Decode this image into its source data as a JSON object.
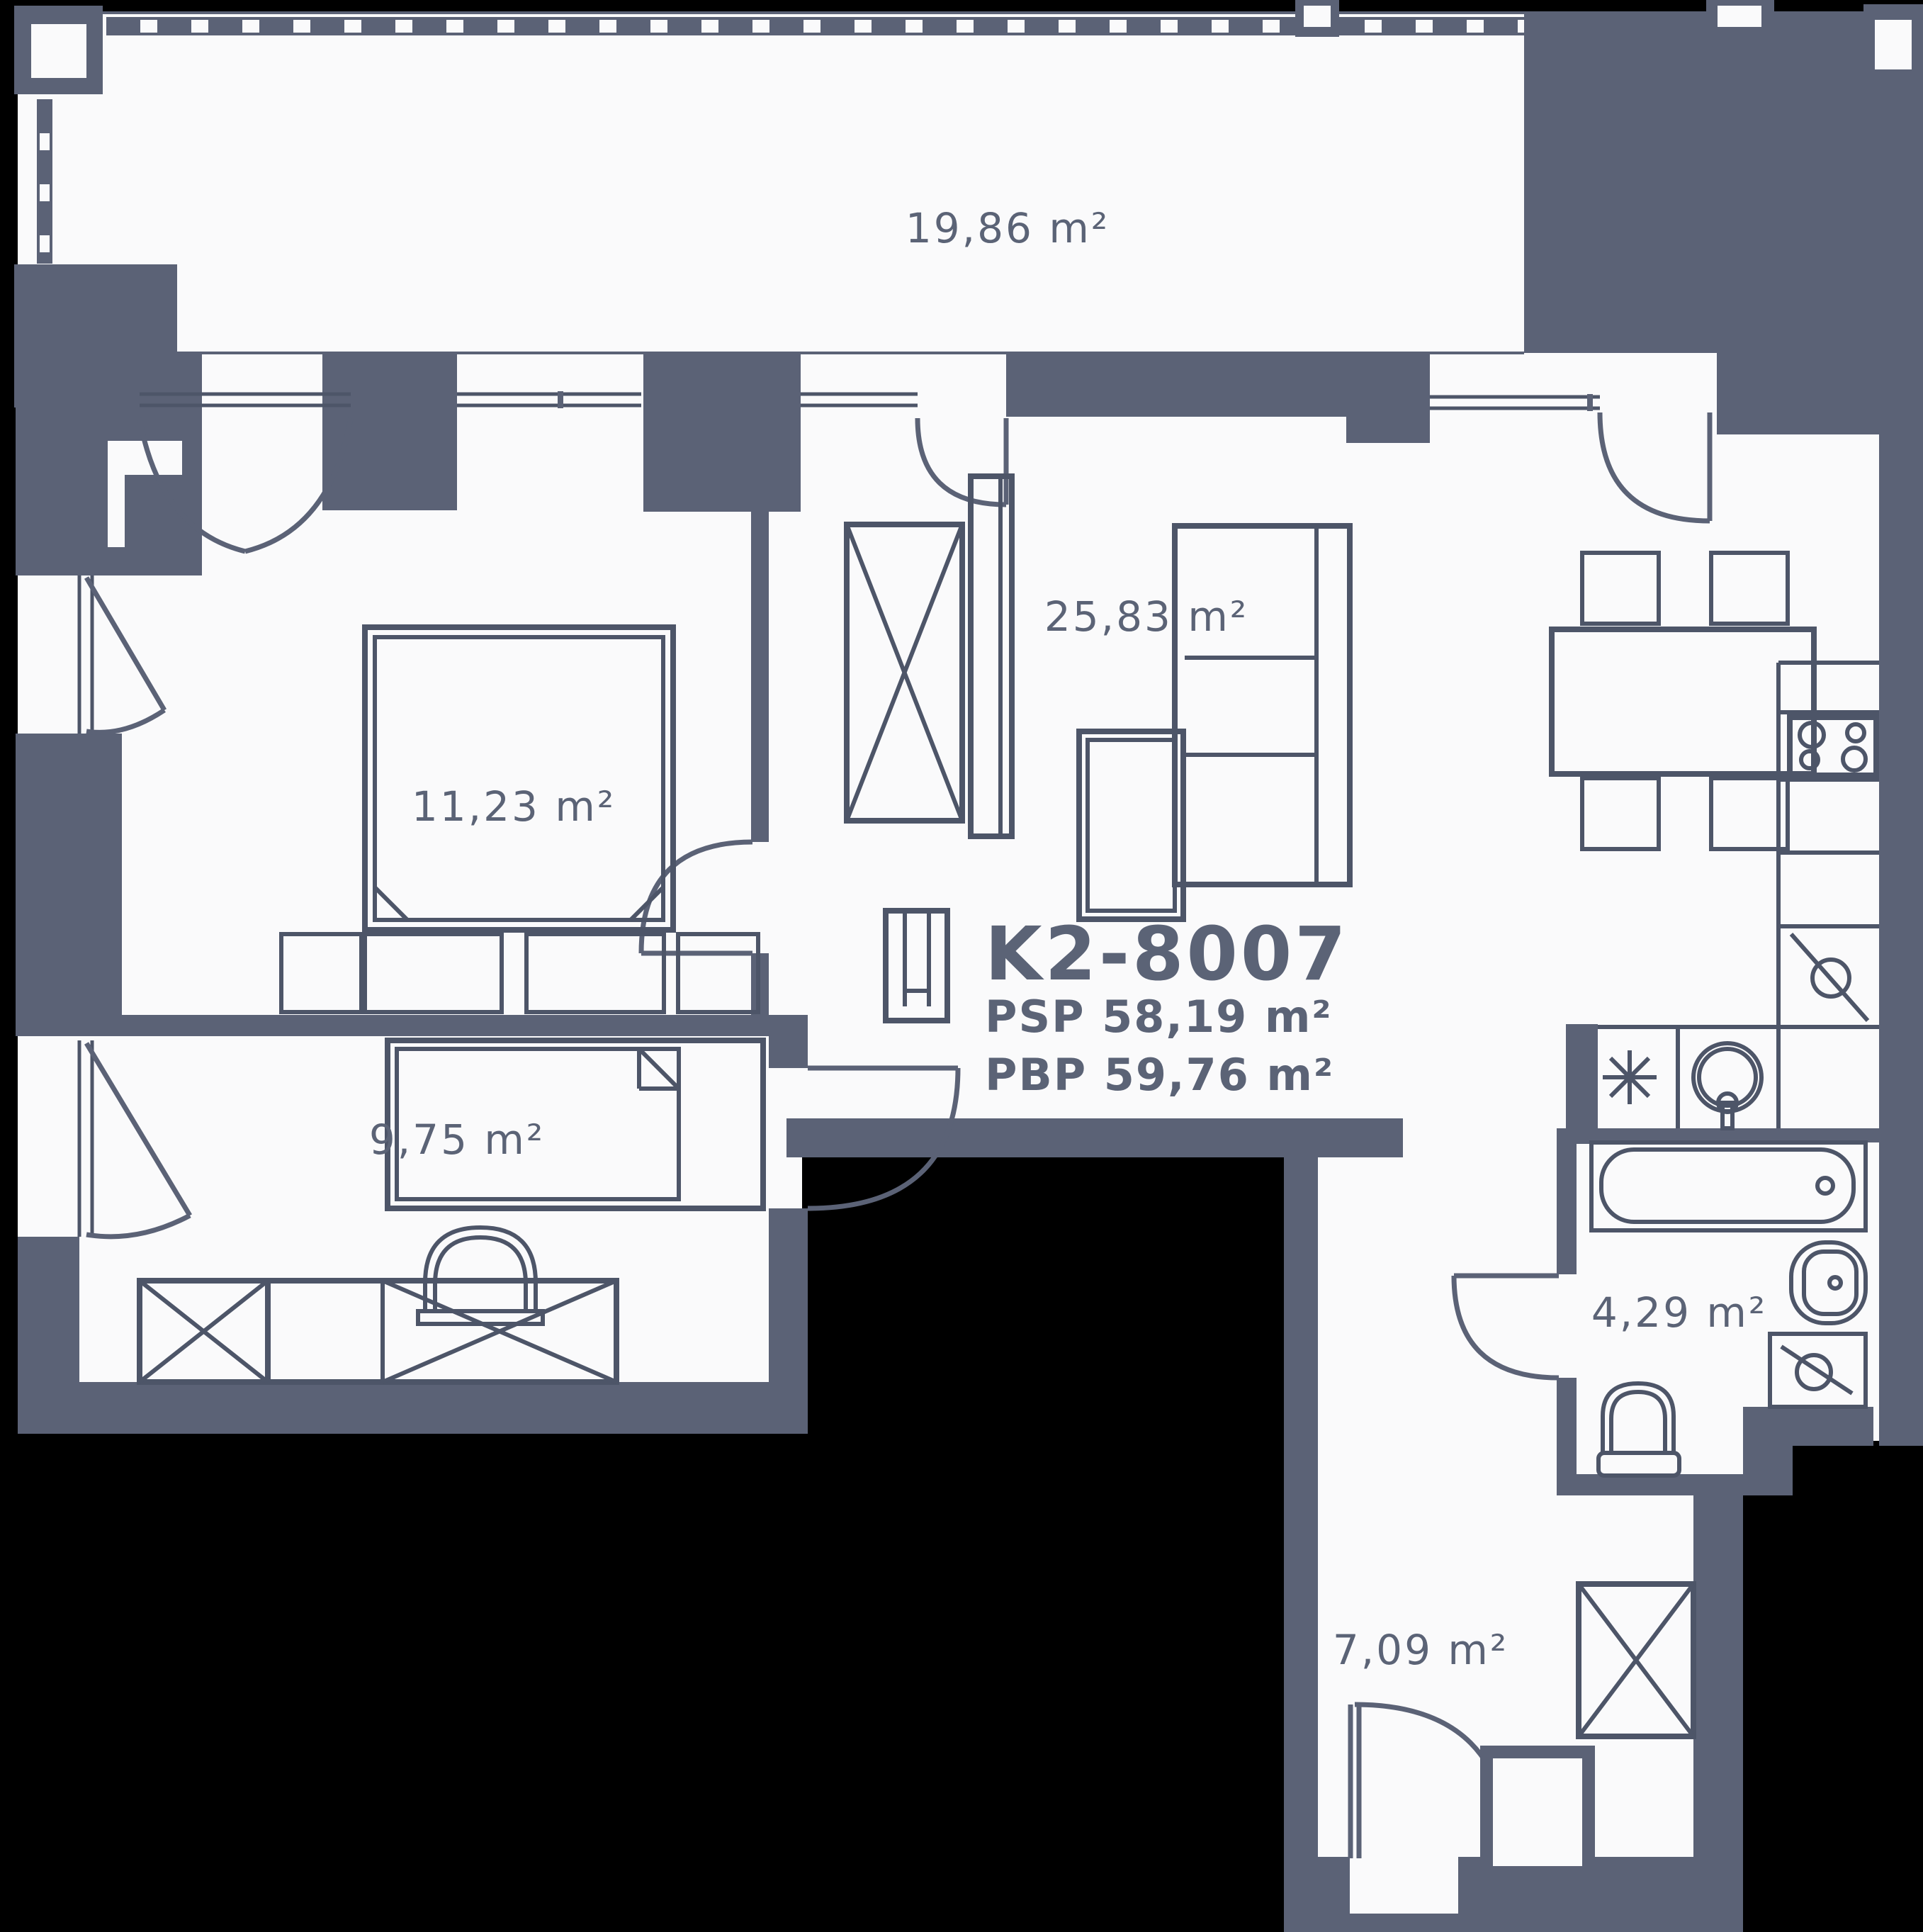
{
  "unit": {
    "id": "K2-8007",
    "psp_label": "PSP 58,19 m²",
    "pbp_label": "PBP 59,76 m²"
  },
  "rooms": [
    {
      "name": "terrace-balcony",
      "area_label": "19,86 m²"
    },
    {
      "name": "bedroom-1",
      "area_label": "11,23 m²"
    },
    {
      "name": "living-room-with-kitchen",
      "area_label": "25,83 m²"
    },
    {
      "name": "bedroom-2",
      "area_label": "9,75 m²"
    },
    {
      "name": "bathroom",
      "area_label": "4,29 m²"
    },
    {
      "name": "hallway",
      "area_label": "7,09 m²"
    }
  ],
  "fixtures": [
    "double-bed",
    "single-bed",
    "wardrobe",
    "sofa",
    "coffee-table",
    "armchair",
    "tv-unit",
    "dining-table",
    "chairs",
    "stove",
    "refrigerator",
    "kitchen-sink",
    "dishwasher",
    "bathtub",
    "washbasin",
    "toilet",
    "towel-dryer",
    "entrance-door"
  ],
  "colors": {
    "background": "#000000",
    "floor": "#fafafb",
    "walls": "#5b6276",
    "lines": "#4d5568",
    "text": "#5b6376"
  }
}
